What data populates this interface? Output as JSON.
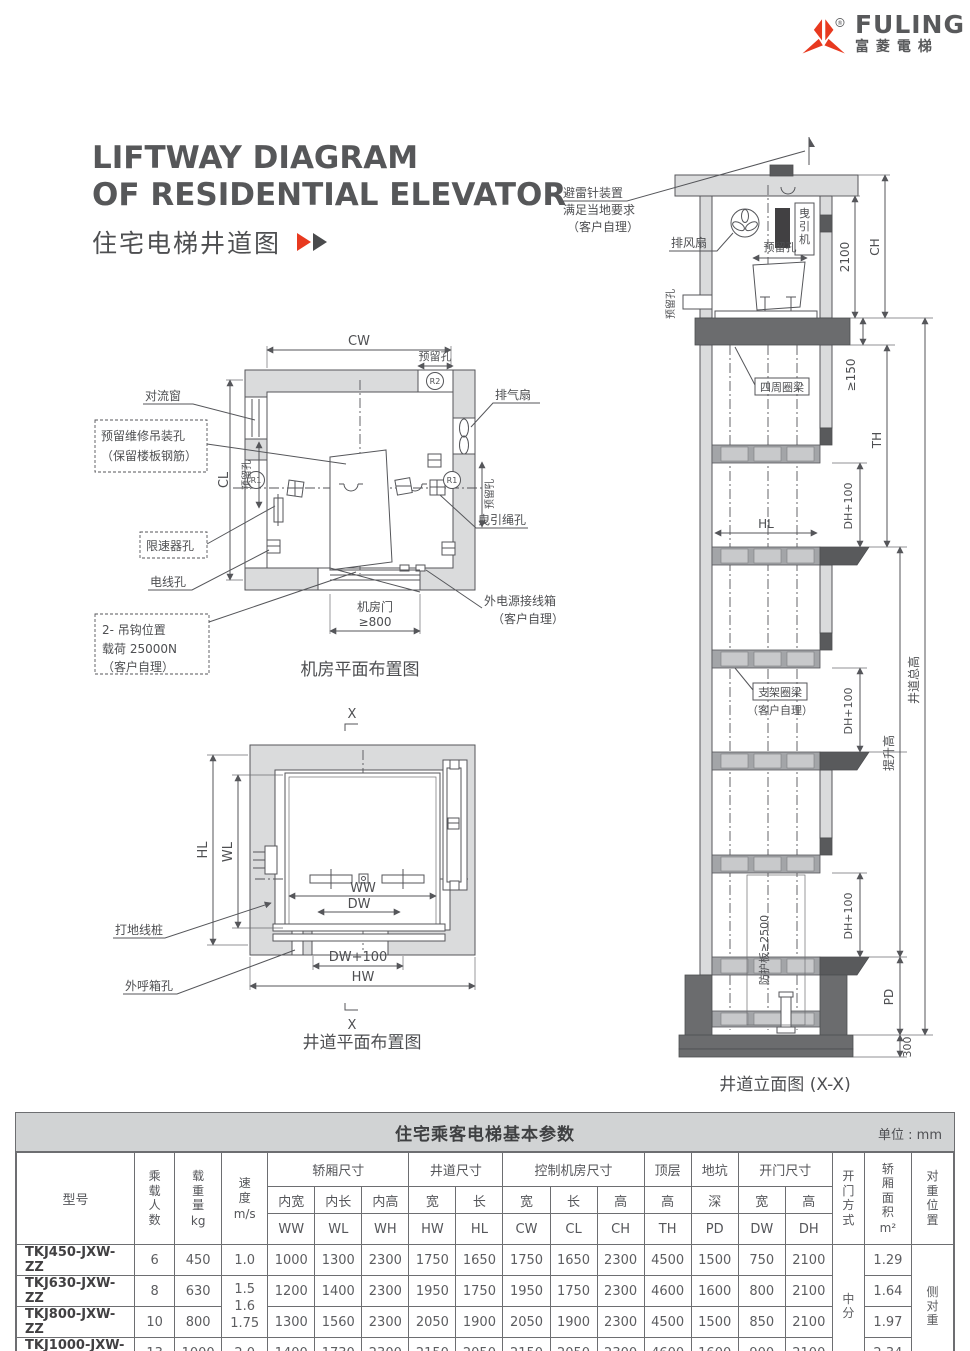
{
  "logo": {
    "brand": "FULING",
    "brand_cn": "富菱電梯",
    "reg": "®"
  },
  "title": {
    "line1": "LIFTWAY DIAGRAM",
    "line2": "OF RESIDENTIAL ELEVATOR",
    "subtitle": "住宅电梯井道图"
  },
  "machine_room_plan": {
    "caption": "机房平面布置图",
    "dims": {
      "cw": "CW",
      "cl": "CL",
      "door": "≥800",
      "reserved_top": "预留孔",
      "reserved_left": "预留孔",
      "reserved_right": "预留孔"
    },
    "marks": {
      "r1": "R1",
      "r1b": "R1",
      "r2": "R2"
    },
    "labels": {
      "convection_window": "对流窗",
      "hoist_hole_line1": "预留维修吊装孔",
      "hoist_hole_line2": "（保留楼板钢筋）",
      "governor_hole": "限速器孔",
      "wire_hole": "电线孔",
      "hook_line1": "2- 吊钩位置",
      "hook_line2": "载荷 25000N",
      "hook_line3": "（客户自理）",
      "door": "机房门",
      "exhaust_fan": "排气扇",
      "rope_hole": "曳引绳孔",
      "power_box_line1": "外电源接线箱",
      "power_box_line2": "（客户自理）"
    }
  },
  "liftway_plan": {
    "caption": "井道平面布置图",
    "section": "X",
    "dims": {
      "hl": "HL",
      "wl": "WL",
      "ww": "WW",
      "dw": "DW",
      "dw100": "DW+100",
      "hw": "HW"
    },
    "labels": {
      "ground_stake": "打地线桩",
      "call_box_hole": "外呼箱孔"
    }
  },
  "elevation": {
    "caption": "井道立面图 (X-X)",
    "labels": {
      "lightning_line1": "避雷针装置",
      "lightning_line2": "满足当地要求",
      "lightning_line3": "（客户自理）",
      "vent_fan": "排风扇",
      "traction_machine": "曳引机",
      "reserved_top": "预留孔",
      "reserved_left": "预留孔",
      "ring_beam": "四周圈梁",
      "bracket_beam_line1": "支架圈梁",
      "bracket_beam_line2": "（客户自理）",
      "guard_plate": "防护板≥2500"
    },
    "dims": {
      "h2100": "2100",
      "ch": "CH",
      "min150": "≥150",
      "th": "TH",
      "dh1": "DH+100",
      "dh2": "DH+100",
      "dh3": "DH+100",
      "hl": "HL",
      "lift_height": "提升高",
      "total_height": "井道总高",
      "pd": "PD",
      "b300": "300"
    }
  },
  "table": {
    "title": "住宅乘客电梯基本参数",
    "unit": "单位 : mm",
    "header": {
      "model": "型号",
      "persons": "乘载人数",
      "load": "载重量",
      "load_unit": "kg",
      "speed": "速度",
      "speed_unit": "m/s",
      "group_car": "轿厢尺寸",
      "group_shaft": "井道尺寸",
      "group_machine": "控制机房尺寸",
      "group_top": "顶层",
      "group_pit": "地坑",
      "group_door": "开门尺寸",
      "sub_ww": "内宽",
      "sub_wl": "内长",
      "sub_wh": "内高",
      "sub_hw": "宽",
      "sub_hl": "长",
      "sub_cw": "宽",
      "sub_cl": "长",
      "sub_ch": "高",
      "sub_th": "高",
      "sub_pd": "深",
      "sub_dw": "宽",
      "sub_dh": "高",
      "code_ww": "WW",
      "code_wl": "WL",
      "code_wh": "WH",
      "code_hw": "HW",
      "code_hl": "HL",
      "code_cw": "CW",
      "code_cl": "CL",
      "code_ch": "CH",
      "code_th": "TH",
      "code_pd": "PD",
      "code_dw": "DW",
      "code_dh": "DH",
      "door_type": "开门方式",
      "area": "轿厢面积",
      "area_unit": "m²",
      "cwt": "对重位置"
    },
    "speed_merged": {
      "a": "1.5",
      "b": "1.6",
      "c": "1.75"
    },
    "door_type_value": "中分",
    "cwt_value": "侧对重",
    "rows": [
      {
        "model": "TKJ450-JXW-ZZ",
        "persons": "6",
        "load": "450",
        "speed": "1.0",
        "ww": "1000",
        "wl": "1300",
        "wh": "2300",
        "hw": "1750",
        "hl": "1650",
        "cw": "1750",
        "cl": "1650",
        "ch": "2300",
        "th": "4500",
        "pd": "1500",
        "dw": "750",
        "dh": "2100",
        "area": "1.29"
      },
      {
        "model": "TKJ630-JXW-ZZ",
        "persons": "8",
        "load": "630",
        "ww": "1200",
        "wl": "1400",
        "wh": "2300",
        "hw": "1950",
        "hl": "1750",
        "cw": "1950",
        "cl": "1750",
        "ch": "2300",
        "th": "4600",
        "pd": "1600",
        "dw": "800",
        "dh": "2100",
        "area": "1.64"
      },
      {
        "model": "TKJ800-JXW-ZZ",
        "persons": "10",
        "load": "800",
        "ww": "1300",
        "wl": "1560",
        "wh": "2300",
        "hw": "2050",
        "hl": "1900",
        "cw": "2050",
        "cl": "1900",
        "ch": "2300",
        "th": "4500",
        "pd": "1500",
        "dw": "850",
        "dh": "2100",
        "area": "1.97"
      },
      {
        "model": "TKJ1000-JXW-ZZ",
        "persons": "13",
        "load": "1000",
        "speed": "2.0",
        "ww": "1400",
        "wl": "1730",
        "wh": "2300",
        "hw": "2150",
        "hl": "2050",
        "cw": "2150",
        "cl": "2050",
        "ch": "2300",
        "th": "4600",
        "pd": "1600",
        "dw": "900",
        "dh": "2100",
        "area": "2.34"
      }
    ]
  },
  "colors": {
    "red": "#e8391f",
    "line": "#55565a",
    "wall": "#dadbdc",
    "dark": "#595a5c",
    "header_bg": "#d1d3d4"
  }
}
